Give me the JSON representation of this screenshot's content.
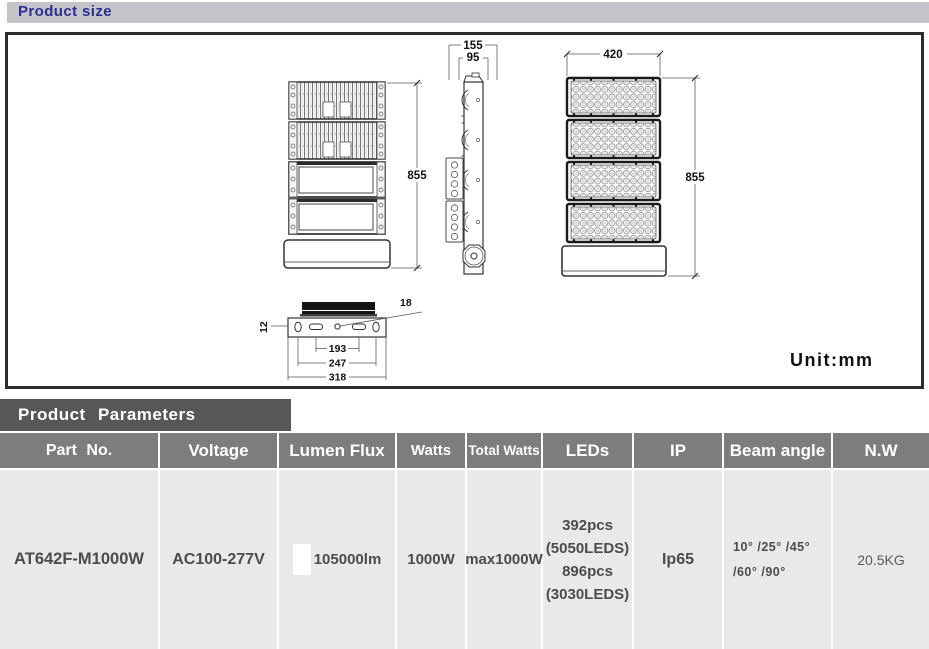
{
  "header": {
    "title": "Product size"
  },
  "drawing": {
    "unit_label": "Unit:mm",
    "back_view": {
      "height_mm": "855"
    },
    "side_view": {
      "top_width_mm": "155",
      "inner_width_mm": "95"
    },
    "front_view": {
      "width_mm": "420",
      "height_mm": "855"
    },
    "bottom_view": {
      "bracket_thickness_mm": "12",
      "hole_mm": "18",
      "inner_span_mm": "193",
      "mid_span_mm": "247",
      "outer_span_mm": "318"
    }
  },
  "parameters": {
    "title": "Product Parameters",
    "columns": [
      "Part No.",
      "Voltage",
      "Lumen Flux",
      "Watts",
      "Total Watts",
      "LEDs",
      "IP",
      "Beam angle",
      "N.W"
    ],
    "row": {
      "part_no": "AT642F-M1000W",
      "voltage": "AC100-277V",
      "lumen_flux": "105000lm",
      "watts": "1000W",
      "total_watts": "max1000W",
      "leds": [
        "392pcs",
        "(5050LEDS)",
        "896pcs",
        "(3030LEDS)"
      ],
      "ip": "Ip65",
      "beam_angle": [
        "10° /25° /45°",
        "/60° /90°"
      ],
      "net_weight": "20.5KG"
    }
  },
  "colors": {
    "title_text": "#2b2e91",
    "title_bar_bg": "#c5c5c9",
    "param_bar_bg": "#575757",
    "table_header_bg": "#7d7d7d",
    "table_cell_bg": "#e9e9e9",
    "cell_text": "#4c4c4c"
  }
}
